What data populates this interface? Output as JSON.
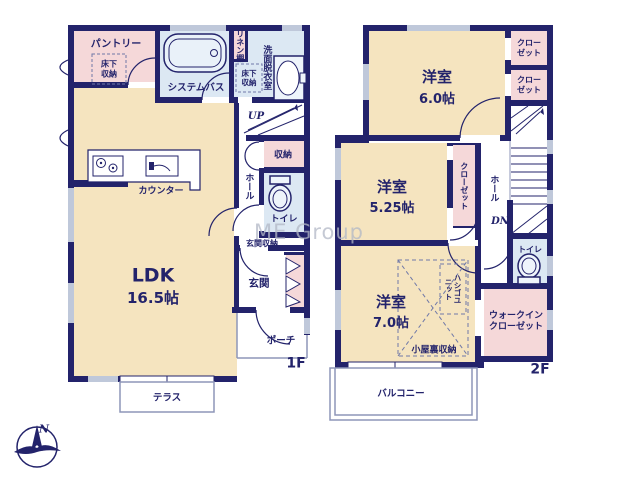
{
  "palette": {
    "wall": "#23236b",
    "room_cream": "#f5e4bf",
    "room_pink": "#f5d8d9",
    "room_blue": "#dce8f3",
    "window_gray": "#bfc8da",
    "thin_line": "#8d96b8",
    "text": "#23236b",
    "watermark": "#b2b8c6"
  },
  "watermark": {
    "text": "ME Group"
  },
  "compass": {
    "north_label": "N"
  },
  "floor1": {
    "floor_label": "1F",
    "pantry": "パントリー",
    "pantry_floor_storage": "床下収納",
    "bath": "システムバス",
    "linen_shelf": "リネン棚",
    "washroom": "洗面脱衣室",
    "washroom_floor_storage": "床下収納",
    "stairs_up": "UP",
    "storage": "収納",
    "hall": "ホール",
    "toilet": "トイレ",
    "entrance_storage": "玄関収納",
    "entrance": "玄関",
    "porch": "ポーチ",
    "ldk": "LDK",
    "ldk_size": "16.5帖",
    "counter": "カウンター",
    "terrace": "テラス"
  },
  "floor2": {
    "floor_label": "2F",
    "bedroom1": "洋室",
    "bedroom1_size": "6.0帖",
    "closet1": "クローゼット",
    "closet2": "クローゼット",
    "bedroom2": "洋室",
    "bedroom2_size": "5.25帖",
    "closet3": "クローゼット",
    "hall": "ホール",
    "stairs_dn": "DN",
    "toilet": "トイレ",
    "ladder_unit": "ハシゴユニット",
    "attic_storage": "小屋裏収納",
    "walk_in_closet": "ウォークインクローゼット",
    "bedroom3": "洋室",
    "bedroom3_size": "7.0帖",
    "balcony": "バルコニー"
  }
}
